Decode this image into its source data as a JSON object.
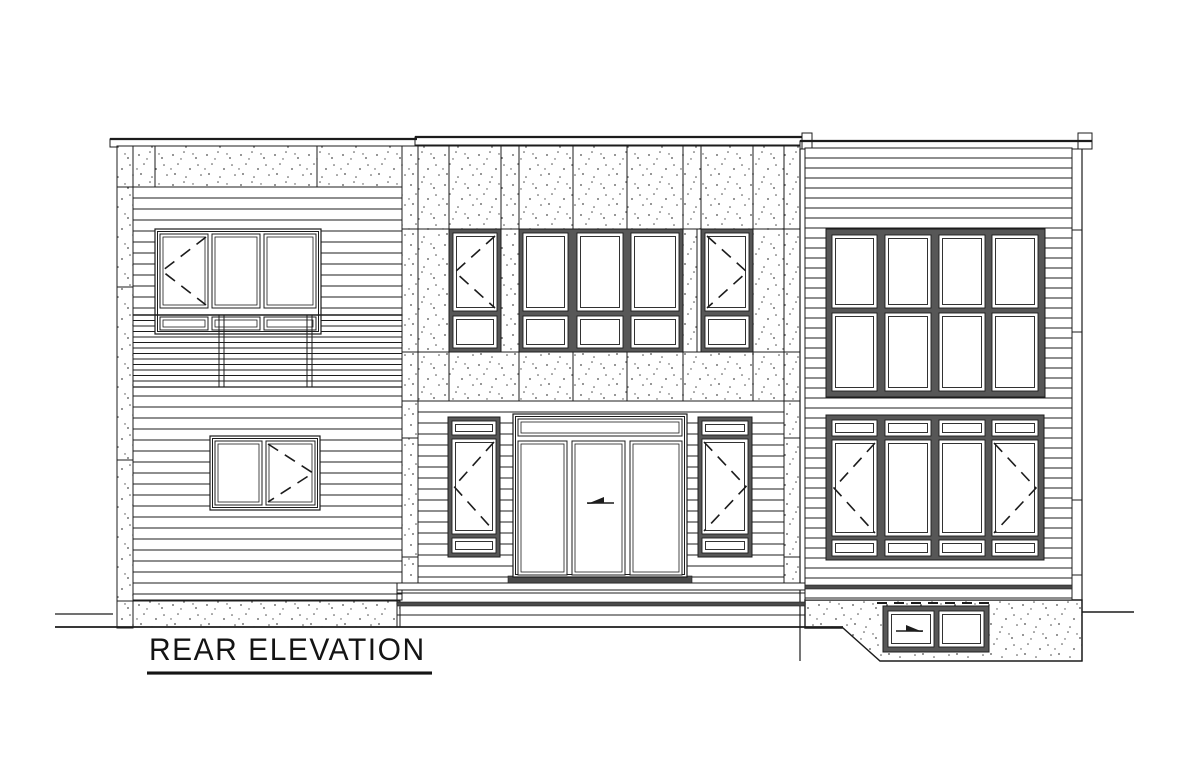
{
  "title": {
    "text": "REAR ELEVATION"
  },
  "drawing": {
    "canvas": {
      "w": 1200,
      "h": 768
    },
    "colors": {
      "line": "#1c1c1c",
      "frame": "#575757",
      "dark": "#4a4a4a",
      "paper": "#ffffff",
      "stipple": "#4d4d4d"
    },
    "caps": [
      {
        "name": "parapet-cap-left",
        "x": 110,
        "y": 139,
        "w": 307,
        "h": 8
      },
      {
        "name": "parapet-cap-middle",
        "x": 415,
        "y": 137,
        "w": 387,
        "h": 8
      },
      {
        "name": "parapet-cap-right",
        "x": 800,
        "y": 141,
        "w": 292,
        "h": 8
      }
    ],
    "cap_blocks": [
      {
        "name": "cap-end-block",
        "x": 802,
        "y": 133,
        "w": 10,
        "h": 16
      },
      {
        "name": "cap-end-block",
        "x": 1078,
        "y": 133,
        "w": 14,
        "h": 16
      }
    ],
    "stucco_rects": [
      {
        "name": "left-pilaster",
        "x": 117,
        "y": 146,
        "w": 16,
        "h": 482
      },
      {
        "name": "left-top-band",
        "x": 133,
        "y": 146,
        "w": 269,
        "h": 41
      },
      {
        "name": "left-foundation",
        "x": 133,
        "y": 601,
        "w": 267,
        "h": 26
      },
      {
        "name": "middle-corner-strip",
        "x": 402,
        "y": 146,
        "w": 16,
        "h": 437
      },
      {
        "name": "middle-corner-strip",
        "x": 784,
        "y": 146,
        "w": 16,
        "h": 437
      },
      {
        "name": "middle-top-band",
        "x": 418,
        "y": 146,
        "w": 366,
        "h": 83
      },
      {
        "name": "middle-window-pier",
        "x": 418,
        "y": 229,
        "w": 31,
        "h": 123
      },
      {
        "name": "middle-window-pier",
        "x": 501,
        "y": 229,
        "w": 18,
        "h": 123
      },
      {
        "name": "middle-window-pier",
        "x": 683,
        "y": 229,
        "w": 14,
        "h": 123
      },
      {
        "name": "middle-window-pier",
        "x": 753,
        "y": 229,
        "w": 31,
        "h": 123
      },
      {
        "name": "middle-sill-band",
        "x": 418,
        "y": 352,
        "w": 366,
        "h": 49
      }
    ],
    "stucco_polygons": [
      {
        "name": "right-walkout-foundation",
        "points": [
          [
            805,
            600
          ],
          [
            1082,
            600
          ],
          [
            1082,
            661
          ],
          [
            880,
            661
          ],
          [
            843,
            628
          ],
          [
            805,
            628
          ]
        ]
      }
    ],
    "siding_fields": [
      {
        "name": "left-siding-field",
        "x": 133,
        "y": 187,
        "w": 269,
        "h": 413,
        "spacing": 11
      },
      {
        "name": "left-rail-band",
        "x": 133,
        "y": 315,
        "w": 269,
        "h": 72,
        "spacing": 5.5
      },
      {
        "name": "middle-lower-siding",
        "x": 418,
        "y": 401,
        "w": 366,
        "h": 182,
        "spacing": 11
      },
      {
        "name": "right-siding-field",
        "x": 805,
        "y": 148,
        "w": 267,
        "h": 452,
        "spacing": 10
      }
    ],
    "lines": [
      [
        55,
        614,
        113,
        614,
        1.3
      ],
      [
        55,
        627,
        843,
        627,
        1.8
      ],
      [
        1082,
        612,
        1134,
        612,
        1.5
      ],
      [
        110,
        139,
        417,
        139,
        2.2
      ],
      [
        415,
        137,
        802,
        137,
        2.2
      ],
      [
        800,
        141,
        1092,
        141,
        2.2
      ],
      [
        155,
        146,
        155,
        187,
        1
      ],
      [
        317,
        146,
        317,
        187,
        1
      ],
      [
        117,
        187,
        133,
        187,
        1
      ],
      [
        117,
        287,
        133,
        287,
        1
      ],
      [
        117,
        460,
        133,
        460,
        1
      ],
      [
        117,
        601,
        133,
        601,
        1
      ],
      [
        402,
        229,
        800,
        229,
        1
      ],
      [
        402,
        352,
        800,
        352,
        1
      ],
      [
        402,
        401,
        800,
        401,
        1
      ],
      [
        449,
        146,
        449,
        229,
        1
      ],
      [
        501,
        146,
        501,
        229,
        1
      ],
      [
        519,
        146,
        519,
        229,
        1
      ],
      [
        573,
        146,
        573,
        229,
        1
      ],
      [
        627,
        146,
        627,
        229,
        1
      ],
      [
        683,
        146,
        683,
        229,
        1
      ],
      [
        701,
        146,
        701,
        229,
        1
      ],
      [
        753,
        146,
        753,
        229,
        1
      ],
      [
        449,
        352,
        449,
        401,
        1
      ],
      [
        519,
        352,
        519,
        401,
        1
      ],
      [
        573,
        352,
        573,
        401,
        1
      ],
      [
        627,
        352,
        627,
        401,
        1
      ],
      [
        683,
        352,
        683,
        401,
        1
      ],
      [
        753,
        352,
        753,
        401,
        1
      ],
      [
        402,
        438,
        418,
        438,
        1
      ],
      [
        402,
        557,
        418,
        557,
        1
      ],
      [
        784,
        438,
        800,
        438,
        1
      ],
      [
        784,
        557,
        800,
        557,
        1
      ],
      [
        397,
        593,
        805,
        593,
        1
      ],
      [
        397,
        615,
        805,
        615,
        1
      ],
      [
        397,
        583,
        397,
        627,
        1
      ],
      [
        805,
        583,
        805,
        627,
        1
      ],
      [
        800,
        149,
        800,
        661,
        1.2
      ],
      [
        805,
        149,
        805,
        600,
        1
      ],
      [
        1072,
        148,
        1072,
        600,
        1
      ],
      [
        1082,
        149,
        1082,
        661,
        1.2
      ],
      [
        1072,
        230,
        1082,
        230,
        1
      ],
      [
        1072,
        332,
        1082,
        332,
        1
      ],
      [
        1072,
        500,
        1082,
        500,
        1
      ],
      [
        1072,
        575,
        1082,
        575,
        1
      ],
      [
        805,
        600,
        1082,
        600,
        1
      ]
    ],
    "post_lines": [
      [
        219,
        315,
        219,
        387,
        1
      ],
      [
        224,
        315,
        224,
        387,
        1
      ],
      [
        307,
        315,
        307,
        387,
        1
      ],
      [
        312,
        315,
        312,
        387,
        1
      ],
      [
        133,
        315,
        402,
        315,
        1.4
      ],
      [
        133,
        387,
        402,
        387,
        1.2
      ]
    ],
    "dashed_lines": [
      [
        877,
        603,
        992,
        603,
        2,
        10,
        7
      ]
    ],
    "white_rects": [
      {
        "name": "patio-step",
        "x": 397,
        "y": 583,
        "w": 408,
        "h": 7
      }
    ],
    "dark_rects": [
      {
        "name": "step-band",
        "x": 397,
        "y": 602,
        "w": 408,
        "h": 4
      },
      {
        "name": "right-trim-band",
        "x": 805,
        "y": 585,
        "w": 267,
        "h": 4
      },
      {
        "name": "door-threshold",
        "x": 508,
        "y": 576,
        "w": 184,
        "h": 7
      }
    ],
    "gray_windows": [
      {
        "name": "middle-upper-window-left",
        "x": 449,
        "y": 229,
        "w": 52,
        "h": 123,
        "panes": [
          [
            453,
            233,
            44,
            78,
            "left"
          ],
          [
            453,
            316,
            44,
            32
          ]
        ]
      },
      {
        "name": "middle-upper-window-center",
        "x": 519,
        "y": 229,
        "w": 164,
        "h": 123,
        "panes": [
          [
            523,
            233,
            45,
            78
          ],
          [
            577,
            233,
            46,
            78
          ],
          [
            631,
            233,
            48,
            78
          ],
          [
            523,
            316,
            45,
            32
          ],
          [
            577,
            316,
            46,
            32
          ],
          [
            631,
            316,
            48,
            32
          ]
        ]
      },
      {
        "name": "middle-upper-window-right",
        "x": 701,
        "y": 229,
        "w": 52,
        "h": 123,
        "panes": [
          [
            705,
            233,
            44,
            78,
            "right"
          ],
          [
            705,
            316,
            44,
            32
          ]
        ]
      },
      {
        "name": "door-sidelite-left",
        "x": 448,
        "y": 417,
        "w": 52,
        "h": 140,
        "panes": [
          [
            452,
            421,
            44,
            14
          ],
          [
            452,
            439,
            44,
            95,
            "left"
          ],
          [
            452,
            538,
            44,
            15
          ]
        ]
      },
      {
        "name": "door-sidelite-right",
        "x": 698,
        "y": 417,
        "w": 54,
        "h": 140,
        "panes": [
          [
            702,
            421,
            46,
            14
          ],
          [
            702,
            439,
            46,
            95,
            "right"
          ],
          [
            702,
            538,
            46,
            15
          ]
        ]
      },
      {
        "name": "right-upper-window-grid",
        "x": 826,
        "y": 229,
        "w": 219,
        "h": 168,
        "panes": [
          [
            832,
            235,
            45,
            73
          ],
          [
            885,
            235,
            46,
            73
          ],
          [
            939,
            235,
            46,
            73
          ],
          [
            992,
            235,
            46,
            73
          ],
          [
            832,
            313,
            45,
            78
          ],
          [
            885,
            313,
            46,
            78
          ],
          [
            939,
            313,
            46,
            78
          ],
          [
            992,
            313,
            46,
            78
          ]
        ]
      },
      {
        "name": "right-lower-window",
        "x": 826,
        "y": 415,
        "w": 218,
        "h": 145,
        "panes": [
          [
            832,
            420,
            45,
            16
          ],
          [
            885,
            420,
            46,
            16
          ],
          [
            939,
            420,
            46,
            16
          ],
          [
            992,
            420,
            46,
            16
          ],
          [
            832,
            440,
            45,
            96,
            "left"
          ],
          [
            885,
            440,
            46,
            96
          ],
          [
            939,
            440,
            46,
            96
          ],
          [
            992,
            440,
            46,
            96,
            "right"
          ],
          [
            832,
            540,
            45,
            16
          ],
          [
            885,
            540,
            46,
            16
          ],
          [
            939,
            540,
            46,
            16
          ],
          [
            992,
            540,
            46,
            16
          ]
        ]
      },
      {
        "name": "basement-window",
        "x": 883,
        "y": 606,
        "w": 106,
        "h": 46,
        "panes": [
          [
            888,
            611,
            46,
            36
          ],
          [
            939,
            611,
            45,
            36
          ]
        ]
      }
    ],
    "thin_windows": [
      {
        "name": "left-upper-window",
        "x": 155,
        "y": 229,
        "w": 166,
        "h": 105,
        "panes": [
          [
            160,
            234,
            48,
            74,
            "left"
          ],
          [
            212,
            234,
            48,
            74
          ],
          [
            264,
            234,
            52,
            74
          ],
          [
            160,
            317,
            48,
            13
          ],
          [
            212,
            317,
            48,
            13
          ],
          [
            264,
            317,
            52,
            13
          ]
        ]
      },
      {
        "name": "left-lower-window",
        "x": 210,
        "y": 436,
        "w": 110,
        "h": 74,
        "panes": [
          [
            215,
            441,
            47,
            64
          ],
          [
            266,
            441,
            49,
            64,
            "right"
          ]
        ]
      },
      {
        "name": "patio-door",
        "x": 513,
        "y": 414,
        "w": 174,
        "h": 163,
        "panes": [
          [
            518,
            419,
            164,
            17
          ],
          [
            518,
            441,
            49,
            134
          ],
          [
            572,
            441,
            53,
            134
          ],
          [
            630,
            441,
            52,
            134
          ]
        ]
      }
    ],
    "arrows": [
      {
        "name": "door-slide-arrow",
        "x": 600,
        "y": 502,
        "dir": "left"
      },
      {
        "name": "basement-slide-arrow",
        "x": 910,
        "y": 630,
        "dir": "right"
      }
    ]
  }
}
